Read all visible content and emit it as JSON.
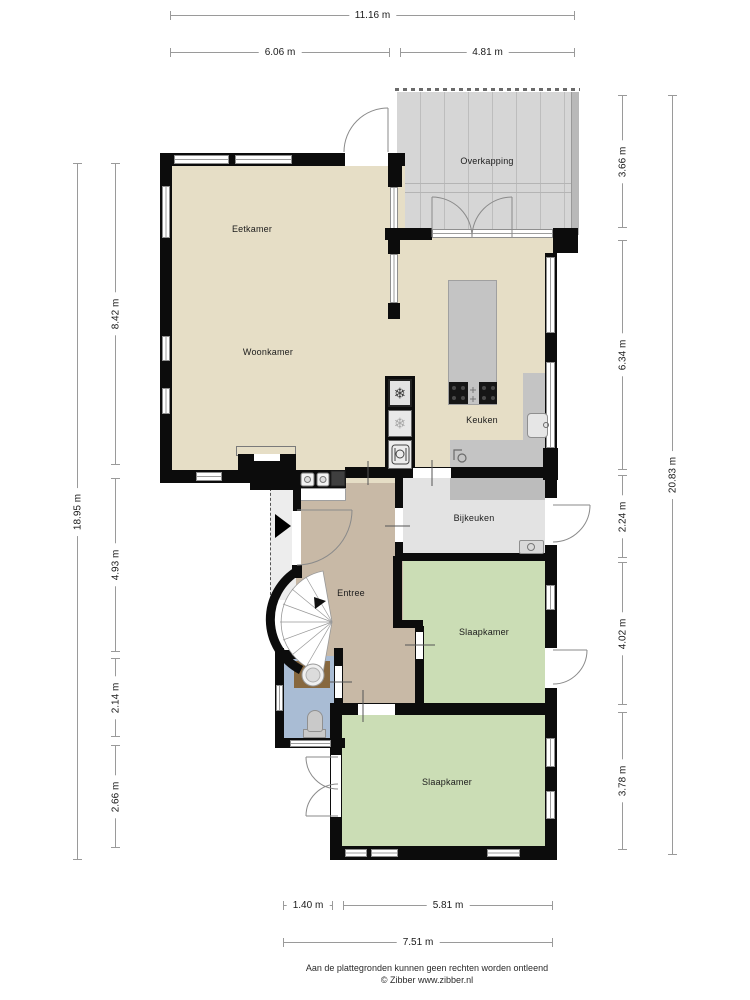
{
  "plan": {
    "rooms": {
      "eetkamer": {
        "label": "Eetkamer"
      },
      "woonkamer": {
        "label": "Woonkamer"
      },
      "keuken": {
        "label": "Keuken"
      },
      "overkapping": {
        "label": "Overkapping"
      },
      "bijkeuken": {
        "label": "Bijkeuken"
      },
      "entree": {
        "label": "Entree"
      },
      "slaapkamer_1": {
        "label": "Slaapkamer"
      },
      "slaapkamer_2": {
        "label": "Slaapkamer"
      }
    },
    "dims": {
      "top": [
        "11.16 m",
        "6.06 m",
        "4.81 m"
      ],
      "left": [
        "18.95 m",
        "8.42 m",
        "4.93 m",
        "2.14 m",
        "2.66 m"
      ],
      "right": [
        "20.83 m",
        "3.66 m",
        "6.34 m",
        "2.24 m",
        "4.02 m",
        "3.78 m"
      ],
      "bottom": [
        "1.40 m",
        "5.81 m",
        "7.51 m"
      ]
    },
    "icons": {
      "freezer": "❄",
      "fridge": "❄"
    },
    "footer": {
      "disclaimer": "Aan de plattegronden kunnen geen rechten worden ontleend",
      "credit": "© Zibber www.zibber.nl"
    },
    "colors": {
      "floor_living": "#e6dec6",
      "floor_hall": "#c8b9a6",
      "floor_bedroom": "#cbddb5",
      "floor_bathroom": "#a9bcd4",
      "floor_utility": "#e3e3e3",
      "outdoor_deck": "#d6d6d6",
      "wall": "#0c0c0c",
      "counter": "#c4c4c4"
    }
  }
}
